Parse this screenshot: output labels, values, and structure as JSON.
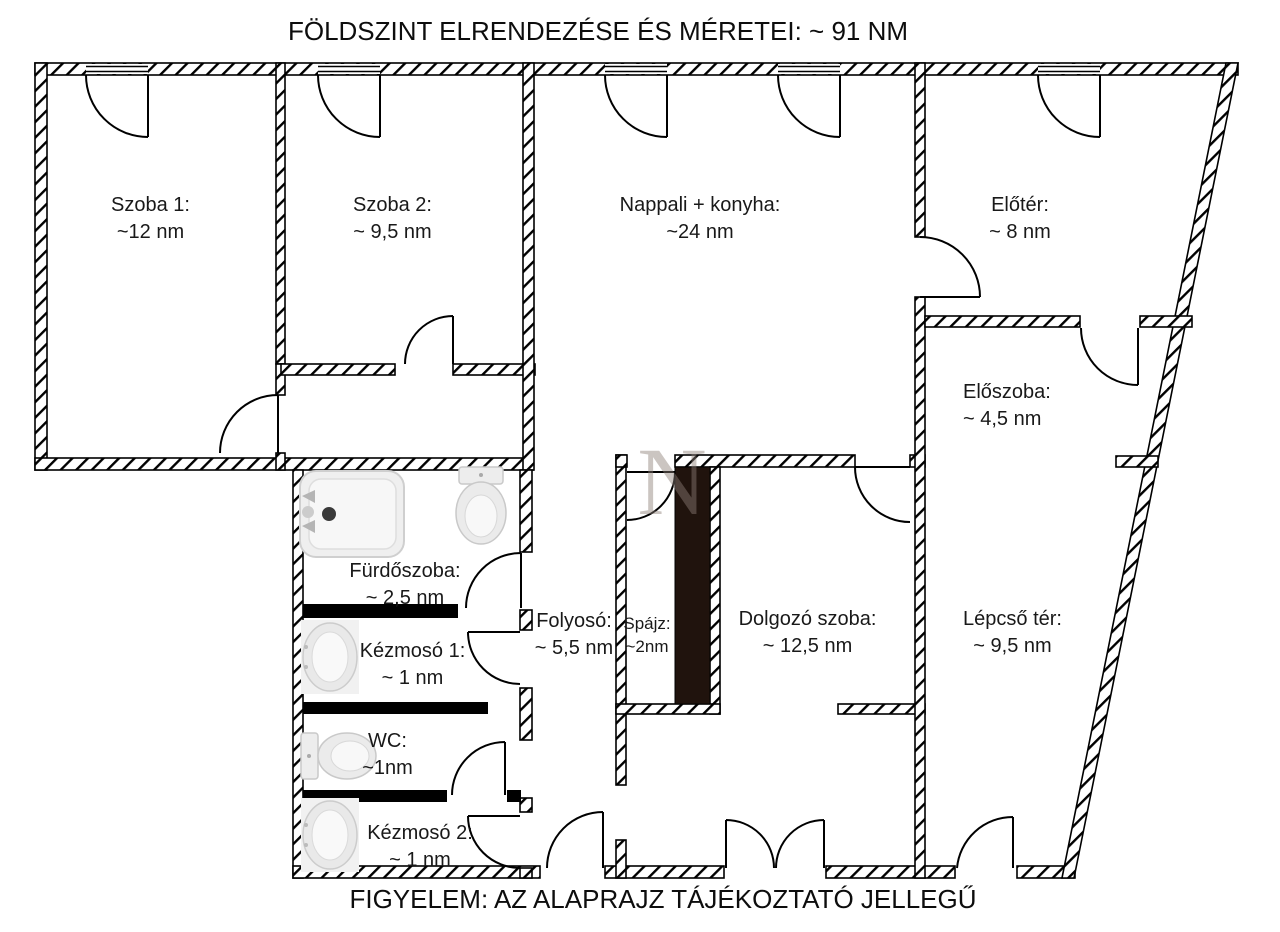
{
  "title": "FÖLDSZINT ELRENDEZÉSE ÉS MÉRETEI: ~ 91 NM",
  "footer": "FIGYELEM: AZ ALAPRAJZ TÁJÉKOZTATÓ JELLEGŰ",
  "watermark": "N",
  "colors": {
    "wall_line": "#000000",
    "pantry_block": "#20130d",
    "fixture_fill": "#ececec"
  },
  "rooms": {
    "szoba1": {
      "name": "Szoba 1:",
      "area": "~12 nm"
    },
    "szoba2": {
      "name": "Szoba 2:",
      "area": "~ 9,5 nm"
    },
    "nappali": {
      "name": "Nappali + konyha:",
      "area": "~24 nm"
    },
    "eloter": {
      "name": "Előtér:",
      "area": "~ 8 nm"
    },
    "eloszoba": {
      "name": "Előszoba:",
      "area": "~ 4,5 nm"
    },
    "furdoszoba": {
      "name": "Fürdőszoba:",
      "area": "~ 2,5 nm"
    },
    "kezmoso1": {
      "name": "Kézmosó 1:",
      "area": "~ 1 nm"
    },
    "wc": {
      "name": "WC:",
      "area": "~1nm"
    },
    "kezmoso2": {
      "name": "Kézmosó 2:",
      "area": "~ 1 nm"
    },
    "folyoso": {
      "name": "Folyosó:",
      "area": "~ 5,5 nm"
    },
    "spajz": {
      "name": "Spájz:",
      "area": "~2nm"
    },
    "dolgozo": {
      "name": "Dolgozó szoba:",
      "area": "~ 12,5 nm"
    },
    "lepcso": {
      "name": "Lépcső tér:",
      "area": "~ 9,5 nm"
    }
  },
  "fixtures": {
    "bathtub": "bathtub",
    "toilet_bathroom": "toilet",
    "sink_1": "sink",
    "toilet_wc": "toilet",
    "sink_2": "sink"
  }
}
